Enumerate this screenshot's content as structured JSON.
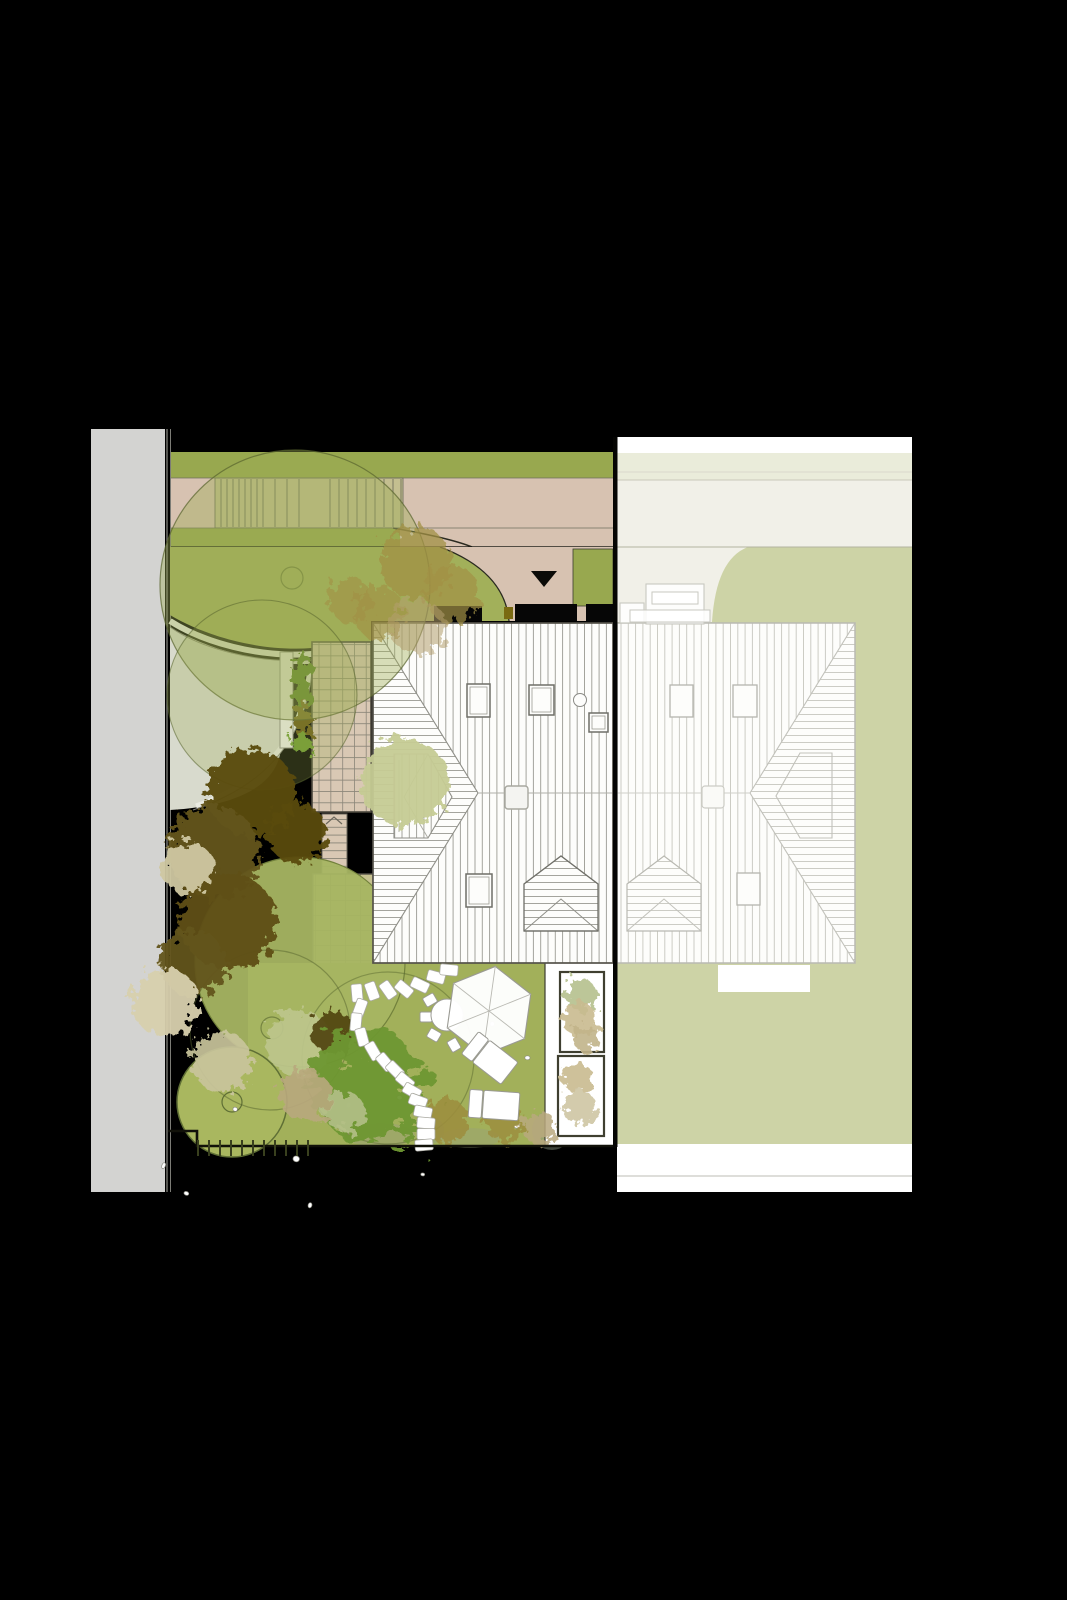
{
  "document": {
    "kind": "landscape-site-plan-drawing",
    "visible_text": [],
    "palette": {
      "bg": "#000000",
      "road": "#d3d3d1",
      "road_line": "#8b8b86",
      "lawn": "#a2b05a",
      "lawn_bright": "#a7b562",
      "band_green": "#98a84f",
      "tan": "#d7c2b1",
      "khaki": "#c4bf90",
      "drive": "#d8dacd",
      "curb": "#eaebe2",
      "offwhite": "#f1f0e8",
      "sage_band": "#eaecda",
      "muted_green": "#cdd3a6",
      "roof_white": "#fdfdfb",
      "roof_line": "#97978f",
      "roof_line_faded": "#c6c6bf",
      "outline_dark": "#4a473c",
      "tile": "#d9c8b4",
      "tile_line": "#8b8679",
      "pad": "#c6c190",
      "hedge_green": "#4c7a1d",
      "hedge_brown": "#6a5a17",
      "bed_border": "#3f3f30",
      "circle_tree": "#a9b75f",
      "canopy_fill": "rgba(158,172,84,0.40)",
      "canopy_stroke": "rgba(88,100,46,0.70)"
    },
    "plan": {
      "trees": [
        {
          "x": 252,
          "y": 793,
          "r": 44,
          "c": "#5a4c10",
          "o": 0.96,
          "t": "round"
        },
        {
          "x": 214,
          "y": 852,
          "r": 46,
          "c": "#64541a",
          "o": 0.96,
          "t": "round"
        },
        {
          "x": 297,
          "y": 833,
          "r": 30,
          "c": "#5a4c10",
          "o": 0.95,
          "t": "round"
        },
        {
          "x": 228,
          "y": 921,
          "r": 48,
          "c": "#5f5013",
          "o": 0.96,
          "t": "round"
        },
        {
          "x": 193,
          "y": 963,
          "r": 33,
          "c": "#64541a",
          "o": 0.95,
          "t": "round"
        },
        {
          "x": 404,
          "y": 782,
          "r": 44,
          "c": "#c6cc94",
          "o": 0.95,
          "t": "round"
        },
        {
          "x": 188,
          "y": 868,
          "r": 26,
          "c": "#cfc8a2",
          "o": 0.95,
          "t": "round"
        },
        {
          "x": 165,
          "y": 1002,
          "r": 34,
          "c": "#d8d0ae",
          "o": 0.95,
          "t": "round"
        },
        {
          "x": 222,
          "y": 1062,
          "r": 30,
          "c": "#c9c59c",
          "o": 0.92,
          "t": "round"
        },
        {
          "x": 299,
          "y": 1043,
          "r": 33,
          "c": "#bdc68c",
          "o": 0.92,
          "t": "round"
        },
        {
          "x": 333,
          "y": 1032,
          "r": 22,
          "c": "#4f4210",
          "o": 0.9,
          "t": "round"
        },
        {
          "x": 368,
          "y": 1085,
          "r": 56,
          "c": "#6e9733",
          "o": 0.95,
          "t": "palm"
        },
        {
          "x": 306,
          "y": 1096,
          "r": 26,
          "c": "#b9a97e",
          "o": 0.9,
          "t": "round"
        },
        {
          "x": 345,
          "y": 1112,
          "r": 20,
          "c": "#b7c28d",
          "o": 0.85,
          "t": "round"
        },
        {
          "x": 416,
          "y": 563,
          "r": 36,
          "c": "#a29145",
          "o": 0.75,
          "t": "round"
        },
        {
          "x": 452,
          "y": 594,
          "r": 28,
          "c": "#a29145",
          "o": 0.7,
          "t": "round"
        },
        {
          "x": 379,
          "y": 613,
          "r": 26,
          "c": "#a29145",
          "o": 0.65,
          "t": "round"
        },
        {
          "x": 350,
          "y": 600,
          "r": 22,
          "c": "#a29145",
          "o": 0.6,
          "t": "round"
        },
        {
          "x": 418,
          "y": 627,
          "r": 28,
          "c": "#b49f6e",
          "o": 0.55,
          "t": "round"
        },
        {
          "x": 446,
          "y": 1120,
          "r": 22,
          "c": "#9d8d3c",
          "o": 0.85,
          "t": "round"
        },
        {
          "x": 504,
          "y": 1122,
          "r": 20,
          "c": "#9d8d3c",
          "o": 0.8,
          "t": "round"
        },
        {
          "x": 540,
          "y": 1128,
          "r": 17,
          "c": "#b9a97e",
          "o": 0.85,
          "t": "round"
        },
        {
          "x": 301,
          "y": 743,
          "r": 10,
          "c": "#7ca23a",
          "o": 0.95,
          "t": "round"
        }
      ],
      "bed_shrubs": [
        {
          "x": 581,
          "y": 995,
          "r": 16,
          "c": "#b9c493",
          "o": 0.95
        },
        {
          "x": 580,
          "y": 1020,
          "r": 17,
          "c": "#c9bb90",
          "o": 0.9
        },
        {
          "x": 585,
          "y": 1038,
          "r": 13,
          "c": "#c2b48a",
          "o": 0.9
        },
        {
          "x": 578,
          "y": 1078,
          "r": 15,
          "c": "#c9bb90",
          "o": 0.9
        },
        {
          "x": 580,
          "y": 1108,
          "r": 17,
          "c": "#cfc6a4",
          "o": 0.9
        }
      ],
      "stones": [
        [
          357,
          993,
          85
        ],
        [
          372,
          991,
          70
        ],
        [
          388,
          990,
          55
        ],
        [
          404,
          989,
          40
        ],
        [
          420,
          985,
          25
        ],
        [
          436,
          977,
          15
        ],
        [
          449,
          970,
          5
        ],
        [
          360,
          1008,
          110
        ],
        [
          356,
          1022,
          95
        ],
        [
          362,
          1037,
          75
        ],
        [
          373,
          1051,
          60
        ],
        [
          385,
          1062,
          50
        ],
        [
          395,
          1070,
          45
        ],
        [
          405,
          1081,
          40
        ],
        [
          412,
          1091,
          30
        ],
        [
          418,
          1101,
          20
        ],
        [
          423,
          1112,
          12
        ],
        [
          426,
          1123,
          5
        ],
        [
          426,
          1134,
          0
        ],
        [
          424,
          1145,
          -5
        ]
      ],
      "ramp_lines_x": [
        221,
        227,
        233,
        239,
        245,
        251,
        257,
        263,
        275,
        287,
        299,
        330,
        339,
        348,
        357,
        366,
        375,
        384,
        393,
        401
      ],
      "boundary_ticks": {
        "x0": 198,
        "step": 11,
        "count": 11,
        "y0": 1140,
        "y1": 1156
      }
    }
  }
}
